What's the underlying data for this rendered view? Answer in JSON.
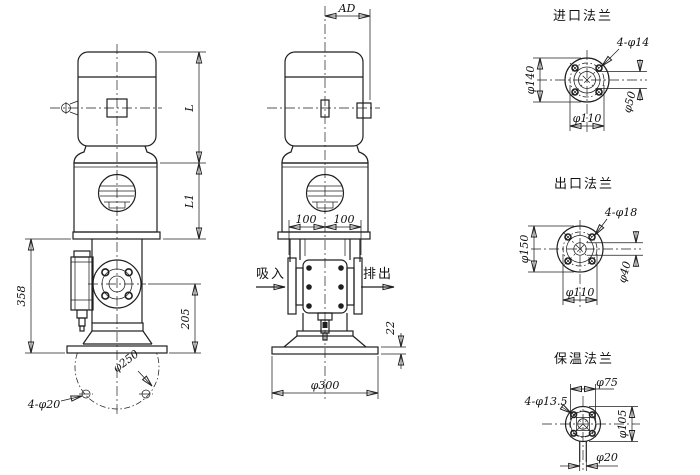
{
  "front_view": {
    "dim_motor_height": "L",
    "dim_bracket_height": "L1",
    "dim_pump_height": "358",
    "dim_flange_center_height": "205",
    "dim_anchor_bolt_circle": "φ250",
    "dim_anchor_holes": "4-φ20"
  },
  "side_view": {
    "dim_ad": "AD",
    "dim_port_left": "100",
    "dim_port_right": "100",
    "label_suction": "吸入",
    "label_discharge": "排出",
    "dim_base_diameter": "φ300",
    "dim_base_thickness": "22"
  },
  "inlet_flange": {
    "title": "进口法兰",
    "dim_holes": "4-φ14",
    "dim_outer": "φ140",
    "dim_bore": "φ50",
    "dim_bolt_circle": "φ110"
  },
  "outlet_flange": {
    "title": "出口法兰",
    "dim_holes": "4-φ18",
    "dim_outer": "φ150",
    "dim_bore": "φ40",
    "dim_bolt_circle": "φ110"
  },
  "insulation_flange": {
    "title": "保温法兰",
    "dim_holes": "4-φ13.5",
    "dim_raised_face": "φ75",
    "dim_outer": "φ105",
    "dim_stem": "φ20"
  },
  "colors": {
    "line": "#1f1f1f",
    "background": "#ffffff"
  }
}
